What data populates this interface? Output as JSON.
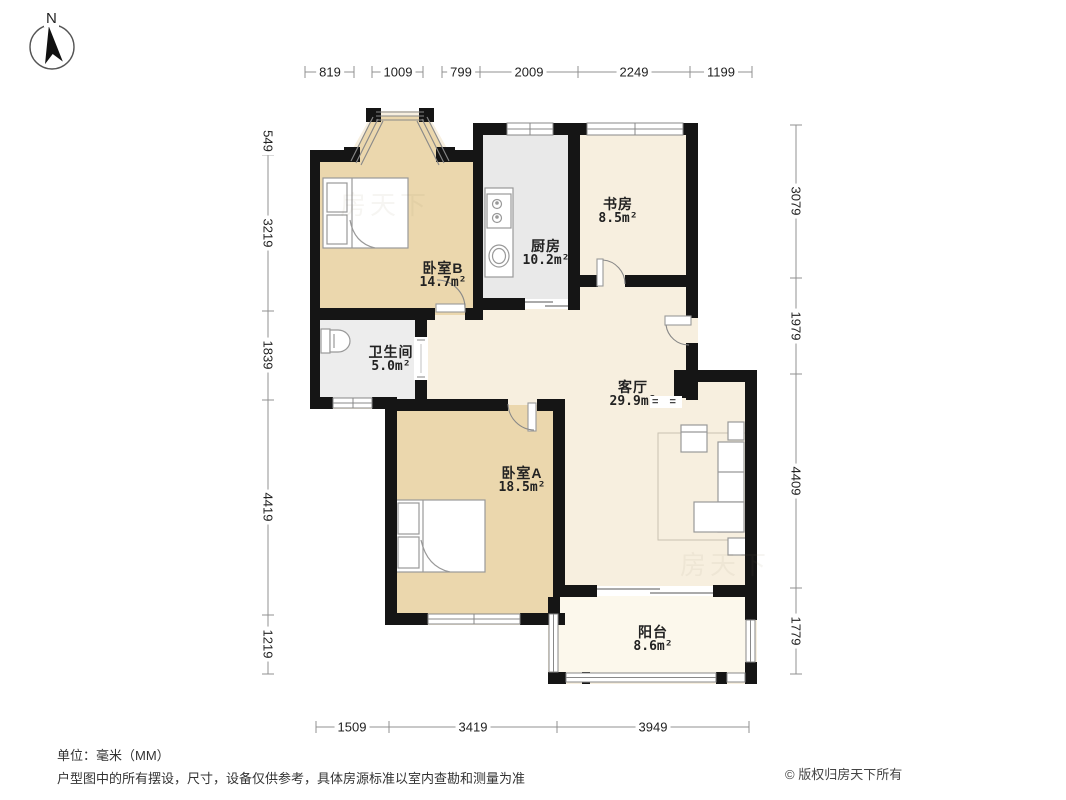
{
  "compass": {
    "label": "N"
  },
  "dimensions": {
    "unit_note": "单位：毫米（MM）",
    "top": [
      "819",
      "1009",
      "799",
      "2009",
      "2249",
      "1199"
    ],
    "left": [
      "549",
      "3219",
      "1839",
      "4419",
      "1219"
    ],
    "right": [
      "3079",
      "1979",
      "4409",
      "1779"
    ],
    "bottom": [
      "1509",
      "3419",
      "3949"
    ]
  },
  "rooms": [
    {
      "id": "bedroom-b",
      "name": "卧室B",
      "area": "14.7m²"
    },
    {
      "id": "kitchen",
      "name": "厨房",
      "area": "10.2m²"
    },
    {
      "id": "study",
      "name": "书房",
      "area": "8.5m²"
    },
    {
      "id": "bathroom",
      "name": "卫生间",
      "area": "5.0m²"
    },
    {
      "id": "living",
      "name": "客厅",
      "area": "29.9m²"
    },
    {
      "id": "bedroom-a",
      "name": "卧室A",
      "area": "18.5m²"
    },
    {
      "id": "balcony",
      "name": "阳台",
      "area": "8.6m²"
    }
  ],
  "living_step_marks": "= =",
  "watermark": "房天下",
  "footer": {
    "unit": "单位：毫米（MM）",
    "disclaimer": "户型图中的所有摆设，尺寸，设备仅供参考，具体房源标准以室内查勘和测量为准",
    "copyright": "© 版权归房天下所有"
  },
  "colors": {
    "wall": "#151515",
    "bedroom_fill": "#ebd7ad",
    "kitchen_fill": "#e9e9e9",
    "bathroom_fill": "#ededed",
    "living_fill": "#f7efdf",
    "balcony_fill": "#fcf8ec",
    "furniture_stroke": "#999999",
    "dimension_line": "#909090",
    "text": "#222222"
  }
}
